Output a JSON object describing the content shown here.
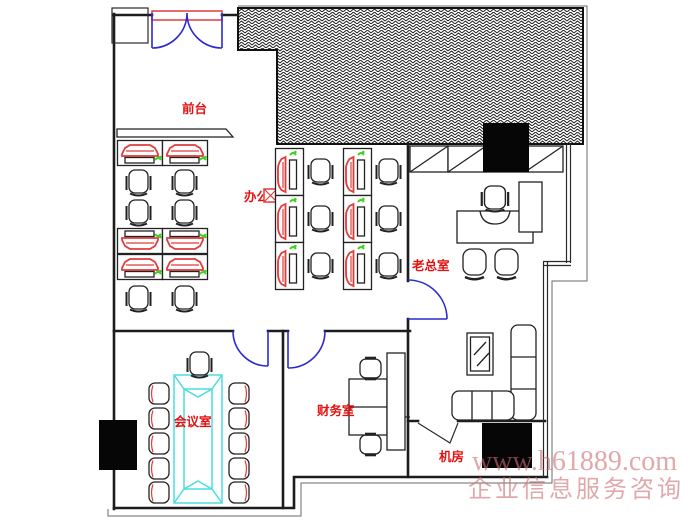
{
  "plan_title": "office floor plan",
  "rooms": {
    "reception": {
      "label": "前台"
    },
    "office_area": {
      "label": "办公区"
    },
    "boss_office": {
      "label": "老总室"
    },
    "meeting_room": {
      "label": "会议室"
    },
    "finance_room": {
      "label": "财务室"
    },
    "server_room": {
      "label": "机房"
    }
  },
  "watermark": {
    "line1": "www.h61889.com",
    "line2": "企业信息服务咨询"
  },
  "colors": {
    "wall": "#1c1c1c",
    "furniture_red": "#e23b3b",
    "phone_green": "#3cd41c",
    "table_cyan": "#49dede",
    "door_blue": "#2a2ad2",
    "label_red": "#e31212",
    "watermark_pink": "#cd6e73",
    "column_black": "#060606"
  }
}
